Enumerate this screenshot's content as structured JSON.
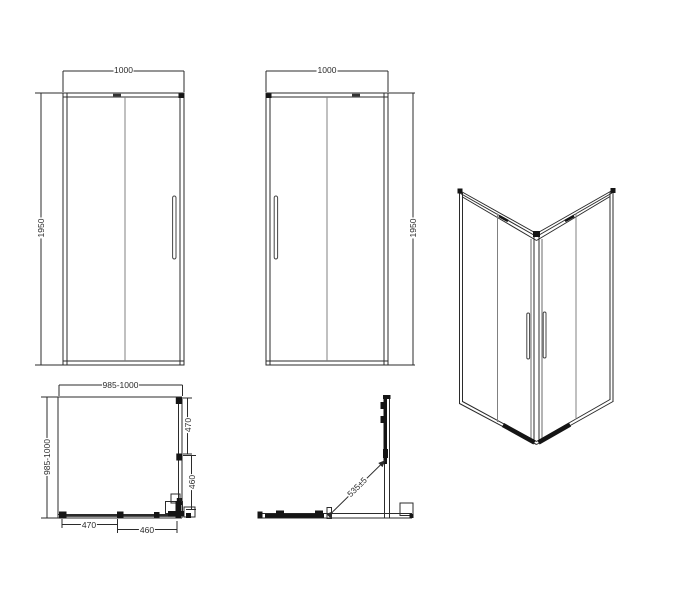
{
  "views": {
    "front_view_a": {
      "width": "1000",
      "height": "1950"
    },
    "front_view_b": {
      "width": "1000",
      "height": "1950"
    },
    "plan_view": {
      "width": "985-1000",
      "depth": "985-1000",
      "right_upper": "470",
      "right_lower": "460",
      "bottom_left": "470",
      "bottom_right": "460"
    },
    "corner_view": {
      "diagonal_opening": "535±5"
    }
  },
  "colors": {
    "line": "#2b2b2b",
    "glass_line": "#808080",
    "fill": "#151515",
    "background": "#ffffff"
  }
}
